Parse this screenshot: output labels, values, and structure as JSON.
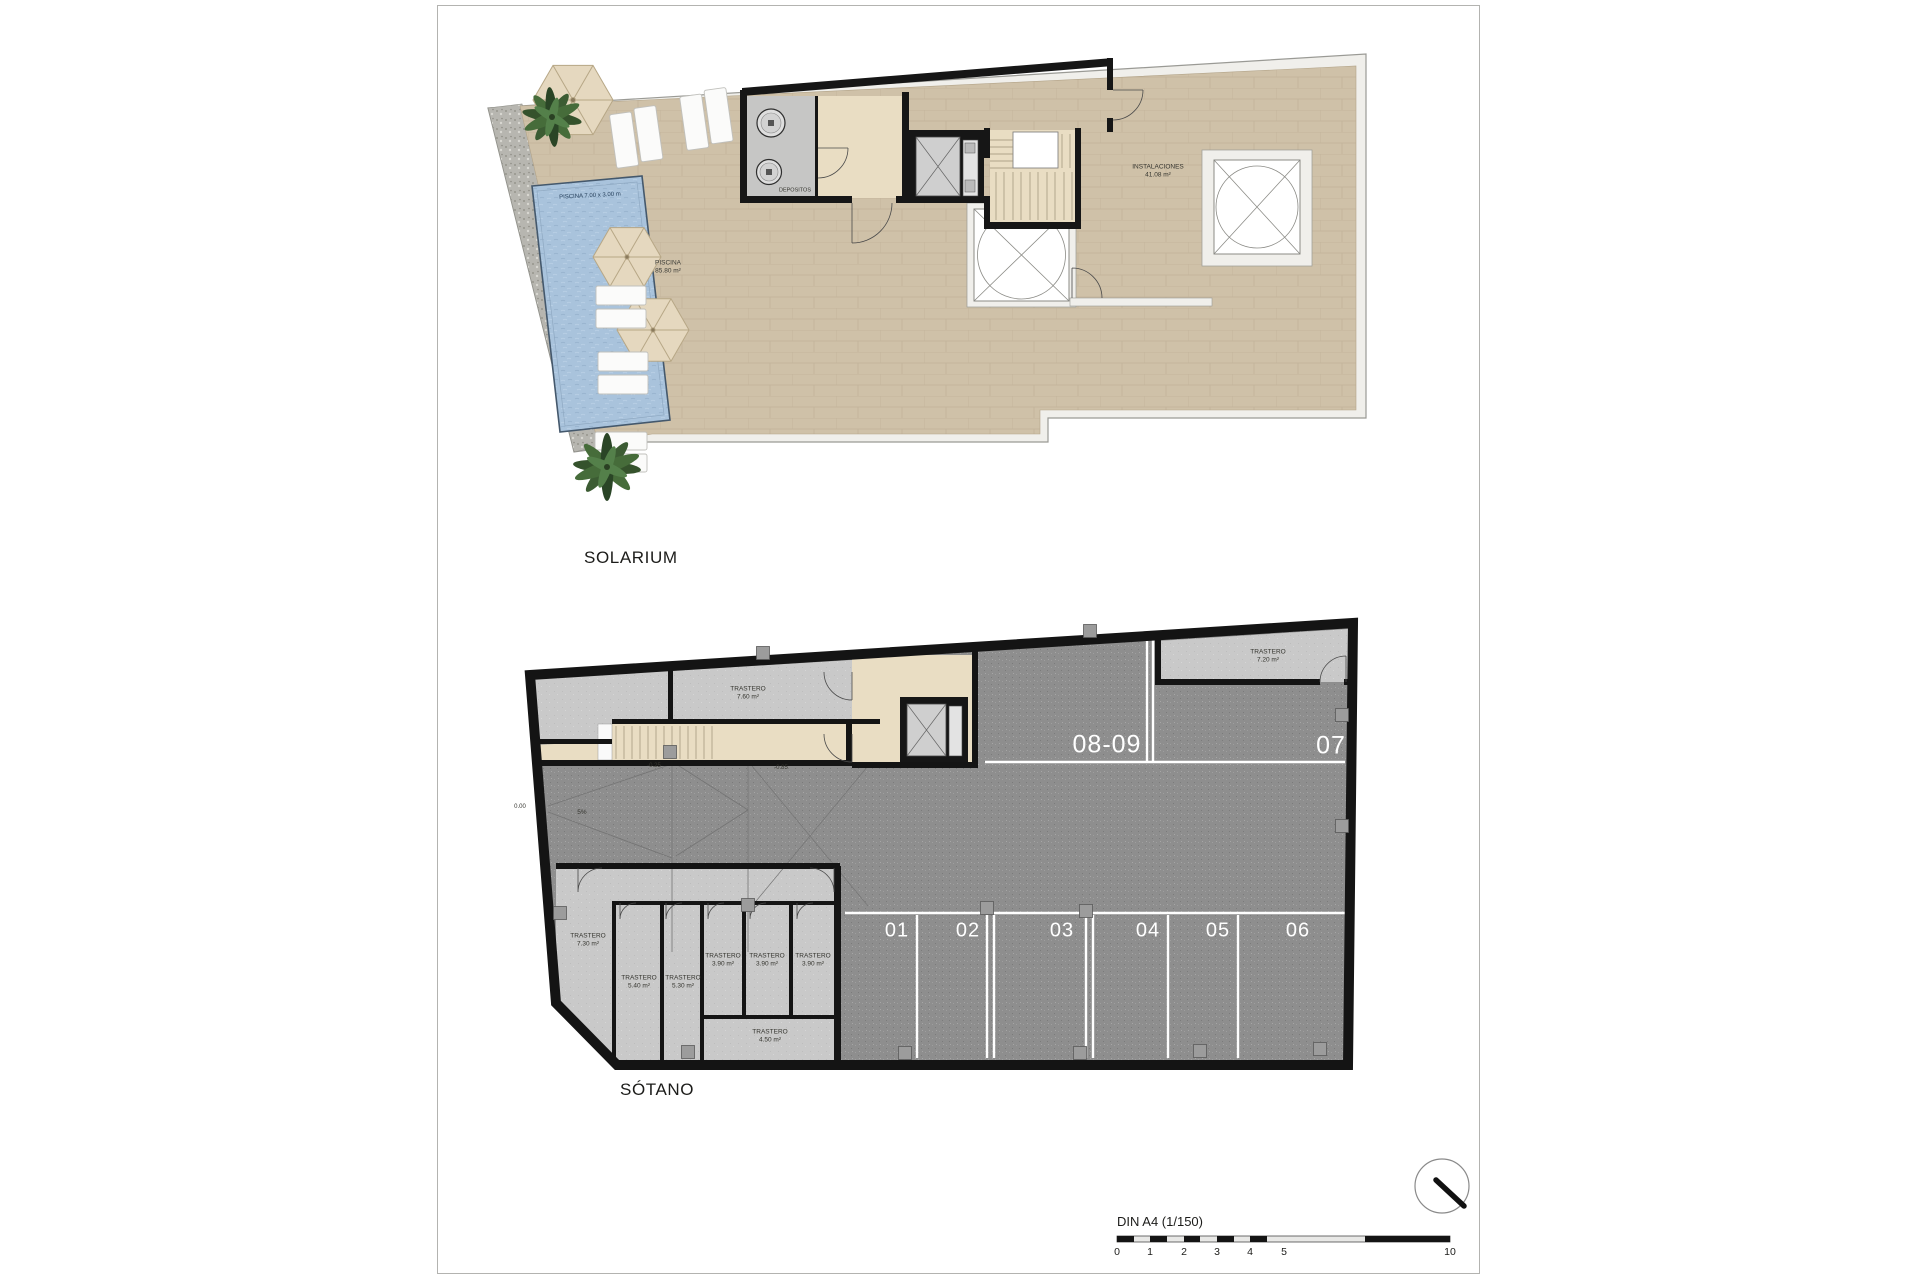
{
  "solarium": {
    "title": "SOLARIUM",
    "pool_dim_label": "PISCINA 7.00 x 3.00 m",
    "pool_label": "PISCINA",
    "pool_area": "85.80 m²",
    "depositos_label": "DEPOSITOS",
    "instalaciones_label": "INSTALACIONES",
    "instalaciones_area": "41.08 m²"
  },
  "sotano": {
    "title": "SÓTANO",
    "storage_top": {
      "label": "TRASTERO",
      "area": "7.60 m²"
    },
    "storage_topright": {
      "label": "TRASTERO",
      "area": "7.20 m²"
    },
    "storage_rooms": [
      {
        "label": "TRASTERO",
        "area": "7.30 m²"
      },
      {
        "label": "TRASTERO",
        "area": "5.40 m²"
      },
      {
        "label": "TRASTERO",
        "area": "5.30 m²"
      },
      {
        "label": "TRASTERO",
        "area": "3.90 m²"
      },
      {
        "label": "TRASTERO",
        "area": "3.90 m²"
      },
      {
        "label": "TRASTERO",
        "area": "3.90 m²"
      },
      {
        "label": "TRASTERO",
        "area": "4.50 m²"
      }
    ],
    "parking_spaces": [
      "01",
      "02",
      "03",
      "04",
      "05",
      "06"
    ],
    "parking_back": [
      "08-09",
      "07"
    ],
    "levels": {
      "zero": "0.00",
      "minus25": "-0.25",
      "minus85": "-0.85",
      "ramp_slope": "5%"
    }
  },
  "footer": {
    "scale_label": "DIN A4 (1/150)",
    "ticks": [
      "0",
      "1",
      "2",
      "3",
      "4",
      "5",
      "10"
    ]
  },
  "colors": {
    "terrace_tile": "#cfc1a8",
    "pool_water": "#a9c3dc",
    "asphalt": "#8e8e8e",
    "storage_gray": "#c9c9c9",
    "wall_black": "#141414",
    "parking_line": "#ffffff",
    "gravel": "#b7b6b0",
    "core_tan": "#e9ddc3"
  }
}
